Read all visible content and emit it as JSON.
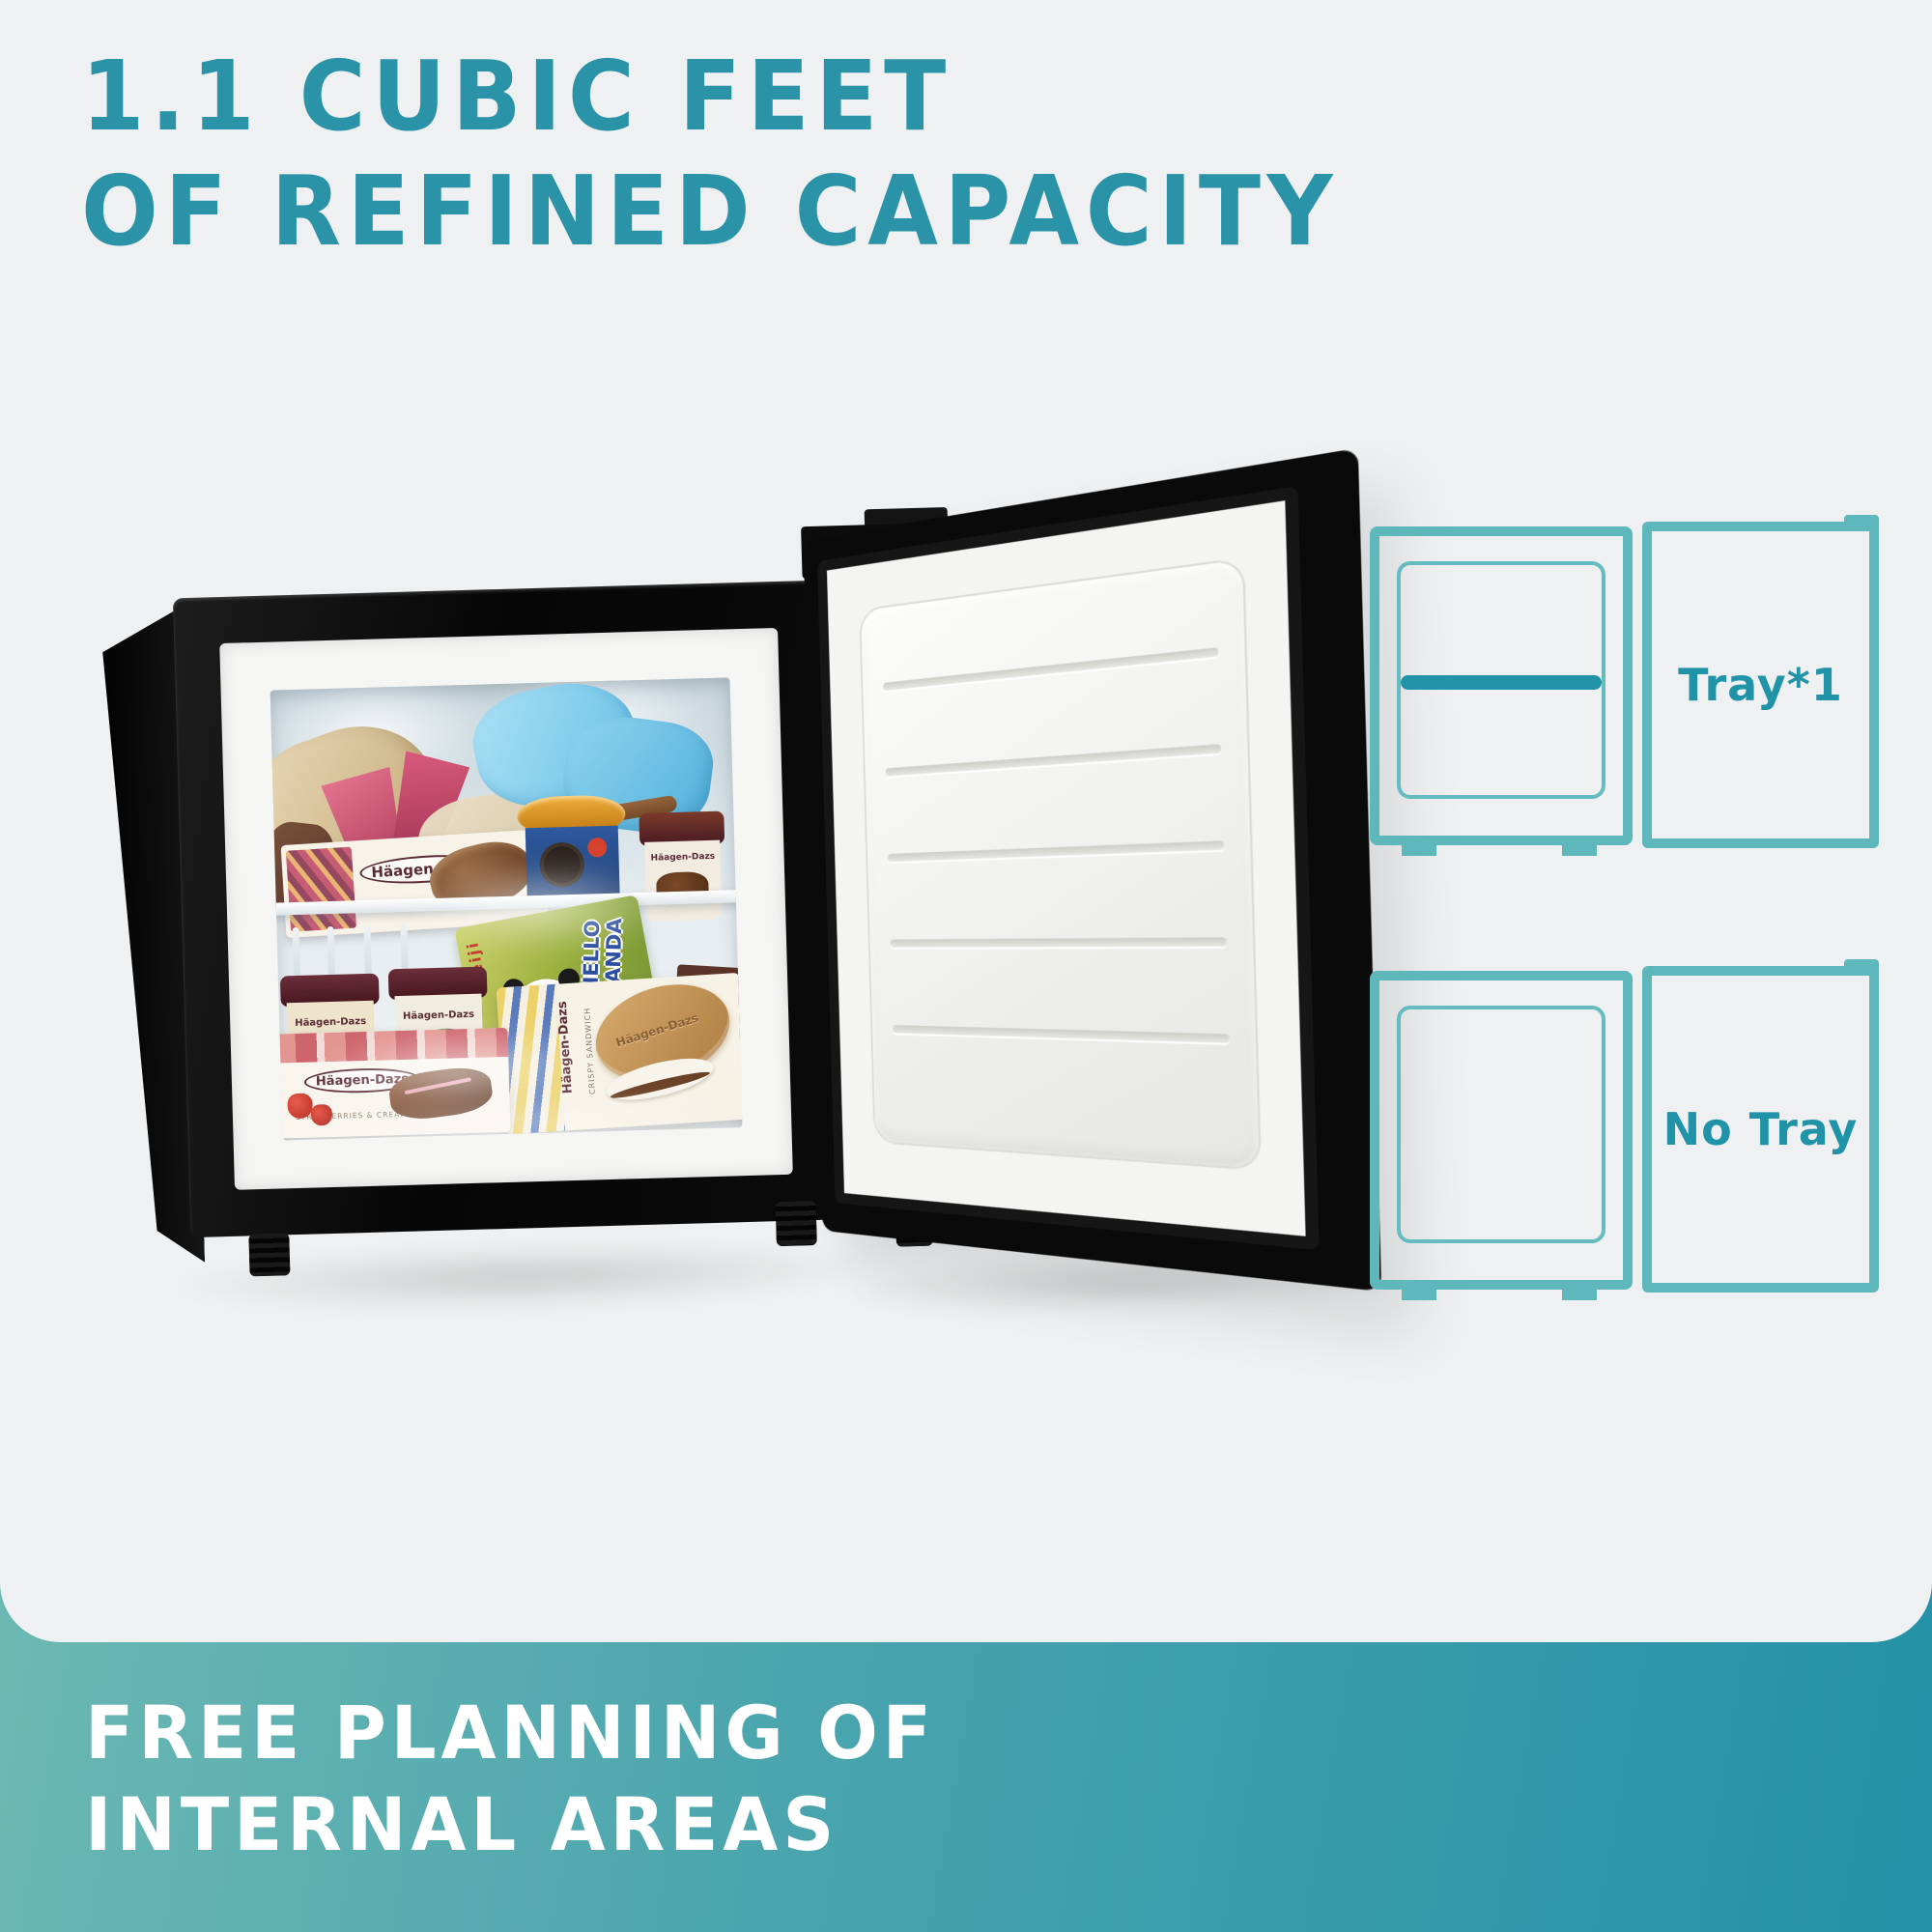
{
  "page": {
    "background_color": "#eef0f1",
    "accent_color": "#2b93a8",
    "diagram_stroke_color": "#5db7bb",
    "tray_color": "#2093a9"
  },
  "headline": {
    "line1": "1.1 CUBIC FEET",
    "line2": "OF REFINED CAPACITY"
  },
  "product_photo": {
    "description": "Open black compact freezer filled with frozen desserts, door swung open to the right",
    "labels": {
      "haagen_dazs": "Häagen-Dazs",
      "chocolate_choc_almond": "CHOCOLATE CHOC ALMOND",
      "crispy_sandwich": "CRISPY SANDWICH",
      "strawberries_cream": "STRAWBERRIES & CREAM",
      "hello_panda": "HELLO PANDA",
      "meiji": "meiji"
    }
  },
  "diagrams": [
    {
      "label": "Tray*1",
      "has_tray": true
    },
    {
      "label": "No Tray",
      "has_tray": false
    }
  ],
  "banner": {
    "line1": "FREE PLANNING OF",
    "line2": "INTERNAL AREAS"
  }
}
